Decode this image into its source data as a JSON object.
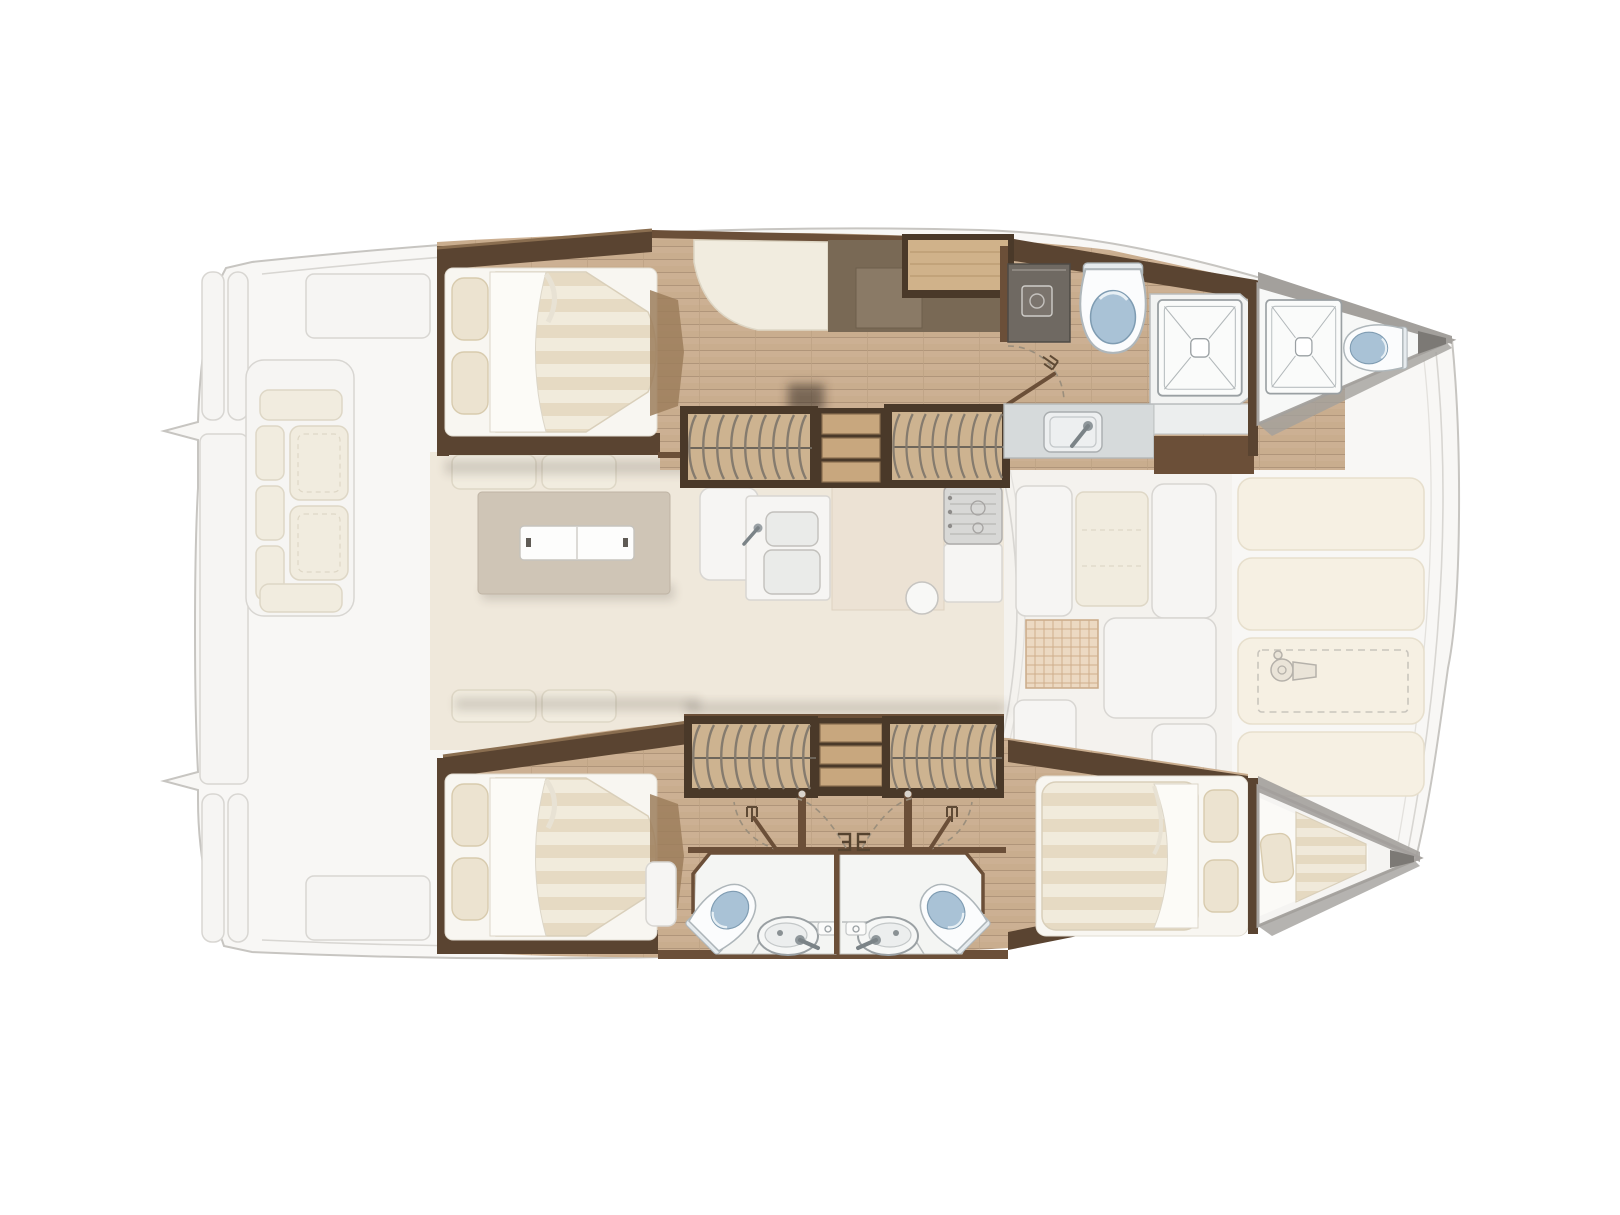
{
  "meta": {
    "type": "floorplan",
    "subject": "catamaran yacht interior layout, overhead deck plan",
    "orientation": "bow-right",
    "canvas": {
      "width": 1620,
      "height": 1215
    }
  },
  "palette": {
    "bg": "#ffffff",
    "ghostFill": "#f8f7f5",
    "ghostLine": "#c7c5c1",
    "ghostInner": "#d8d6d2",
    "ghostCushion": "#f1ecdf",
    "ghostCushionLine": "#ded7c6",
    "ghostTaupe": "#cfc5b6",
    "saloonFloor": "#efe8db",
    "padCream": "#f6f0e3",
    "gridLine": "#cfae8c",
    "wall": "#5a4431",
    "wallLight": "#8a6e50",
    "trim": "#6b4f38",
    "woodBase": "#c9ad8e",
    "plankLine": "#b0957a",
    "cabinetTaupe": "#796955",
    "cabinetTaupeLight": "#8a7a66",
    "shelfWood": "#d0b28a",
    "frameDark": "#4a3929",
    "wardrobeTan": "#cdb390",
    "hanger": "#857b6e",
    "stepWood": "#c8a77e",
    "stepEdge": "#8a6f50",
    "bedBase": "#f8f6f1",
    "mattress": "#f1ebdc",
    "mattressStripe": "#e6dac3",
    "duvet": "#fcfbf7",
    "pillow": "#ece3d0",
    "pillowLine": "#d8cbae",
    "bathFloor": "#f4f5f3",
    "bathLine": "#c6c6c2",
    "toiletBlue": "#a9c2d6",
    "toiletRim": "#fbfcfd",
    "fixtureLine": "#9aa0a3",
    "counter": "#d6dadb",
    "sinkFill": "#edeff0",
    "applianceGray": "#6f6962",
    "deckGray": "#a3a09c",
    "tipGray": "#7c7975"
  },
  "plan": {
    "port_hull": {
      "position": "top",
      "areas": [
        {
          "name": "aft-cabin",
          "fixtures": [
            "double-berth",
            "pillow",
            "pillow",
            "duvet"
          ]
        },
        {
          "name": "passageway",
          "fixtures": [
            "chaise-seat",
            "desk-cabinet",
            "storage-shelf",
            "hanging-locker",
            "companionway-steps",
            "hanging-locker"
          ]
        },
        {
          "name": "bathroom",
          "fixtures": [
            "washing-machine",
            "door",
            "toilet",
            "vanity-sink",
            "faucet",
            "shower-tray"
          ]
        },
        {
          "name": "forepeak-head",
          "fixtures": [
            "shower-tray",
            "toilet"
          ]
        }
      ]
    },
    "starboard_hull": {
      "position": "bottom",
      "areas": [
        {
          "name": "aft-cabin",
          "fixtures": [
            "double-berth",
            "pillow",
            "pillow",
            "duvet"
          ]
        },
        {
          "name": "passageway",
          "fixtures": [
            "hanging-locker",
            "companionway-steps",
            "hanging-locker",
            "cabin-door",
            "cabin-door",
            "cabin-door",
            "cabin-door"
          ]
        },
        {
          "name": "bathroom-aft",
          "fixtures": [
            "toilet",
            "washbasin",
            "faucet",
            "shelf"
          ]
        },
        {
          "name": "bathroom-forward",
          "fixtures": [
            "toilet",
            "washbasin",
            "faucet",
            "shelf"
          ]
        },
        {
          "name": "forward-cabin",
          "fixtures": [
            "double-berth",
            "pillow",
            "pillow",
            "duvet"
          ]
        },
        {
          "name": "forepeak-berth",
          "fixtures": [
            "berth-pad",
            "pillow"
          ]
        }
      ]
    },
    "exterior_ghosted": {
      "areas": [
        {
          "name": "aft-cockpit",
          "fixtures": [
            "bench-sofa",
            "transom-steps",
            "swim-platform",
            "deck-locker",
            "deck-locker"
          ]
        },
        {
          "name": "saloon",
          "fixtures": [
            "settee-cushions",
            "dining-table",
            "serving-tray",
            "seat",
            "galley-double-sink",
            "galley-island",
            "stove",
            "round-basin"
          ]
        },
        {
          "name": "forward-cockpit",
          "fixtures": [
            "bench-seat",
            "bench-seat",
            "bench-seat",
            "woven-table",
            "bench-seat",
            "bench-seat"
          ]
        },
        {
          "name": "foredeck",
          "fixtures": [
            "sunpad",
            "sunpad",
            "sunpad",
            "sunpad",
            "windlass-hatch",
            "windlass"
          ]
        }
      ]
    }
  }
}
